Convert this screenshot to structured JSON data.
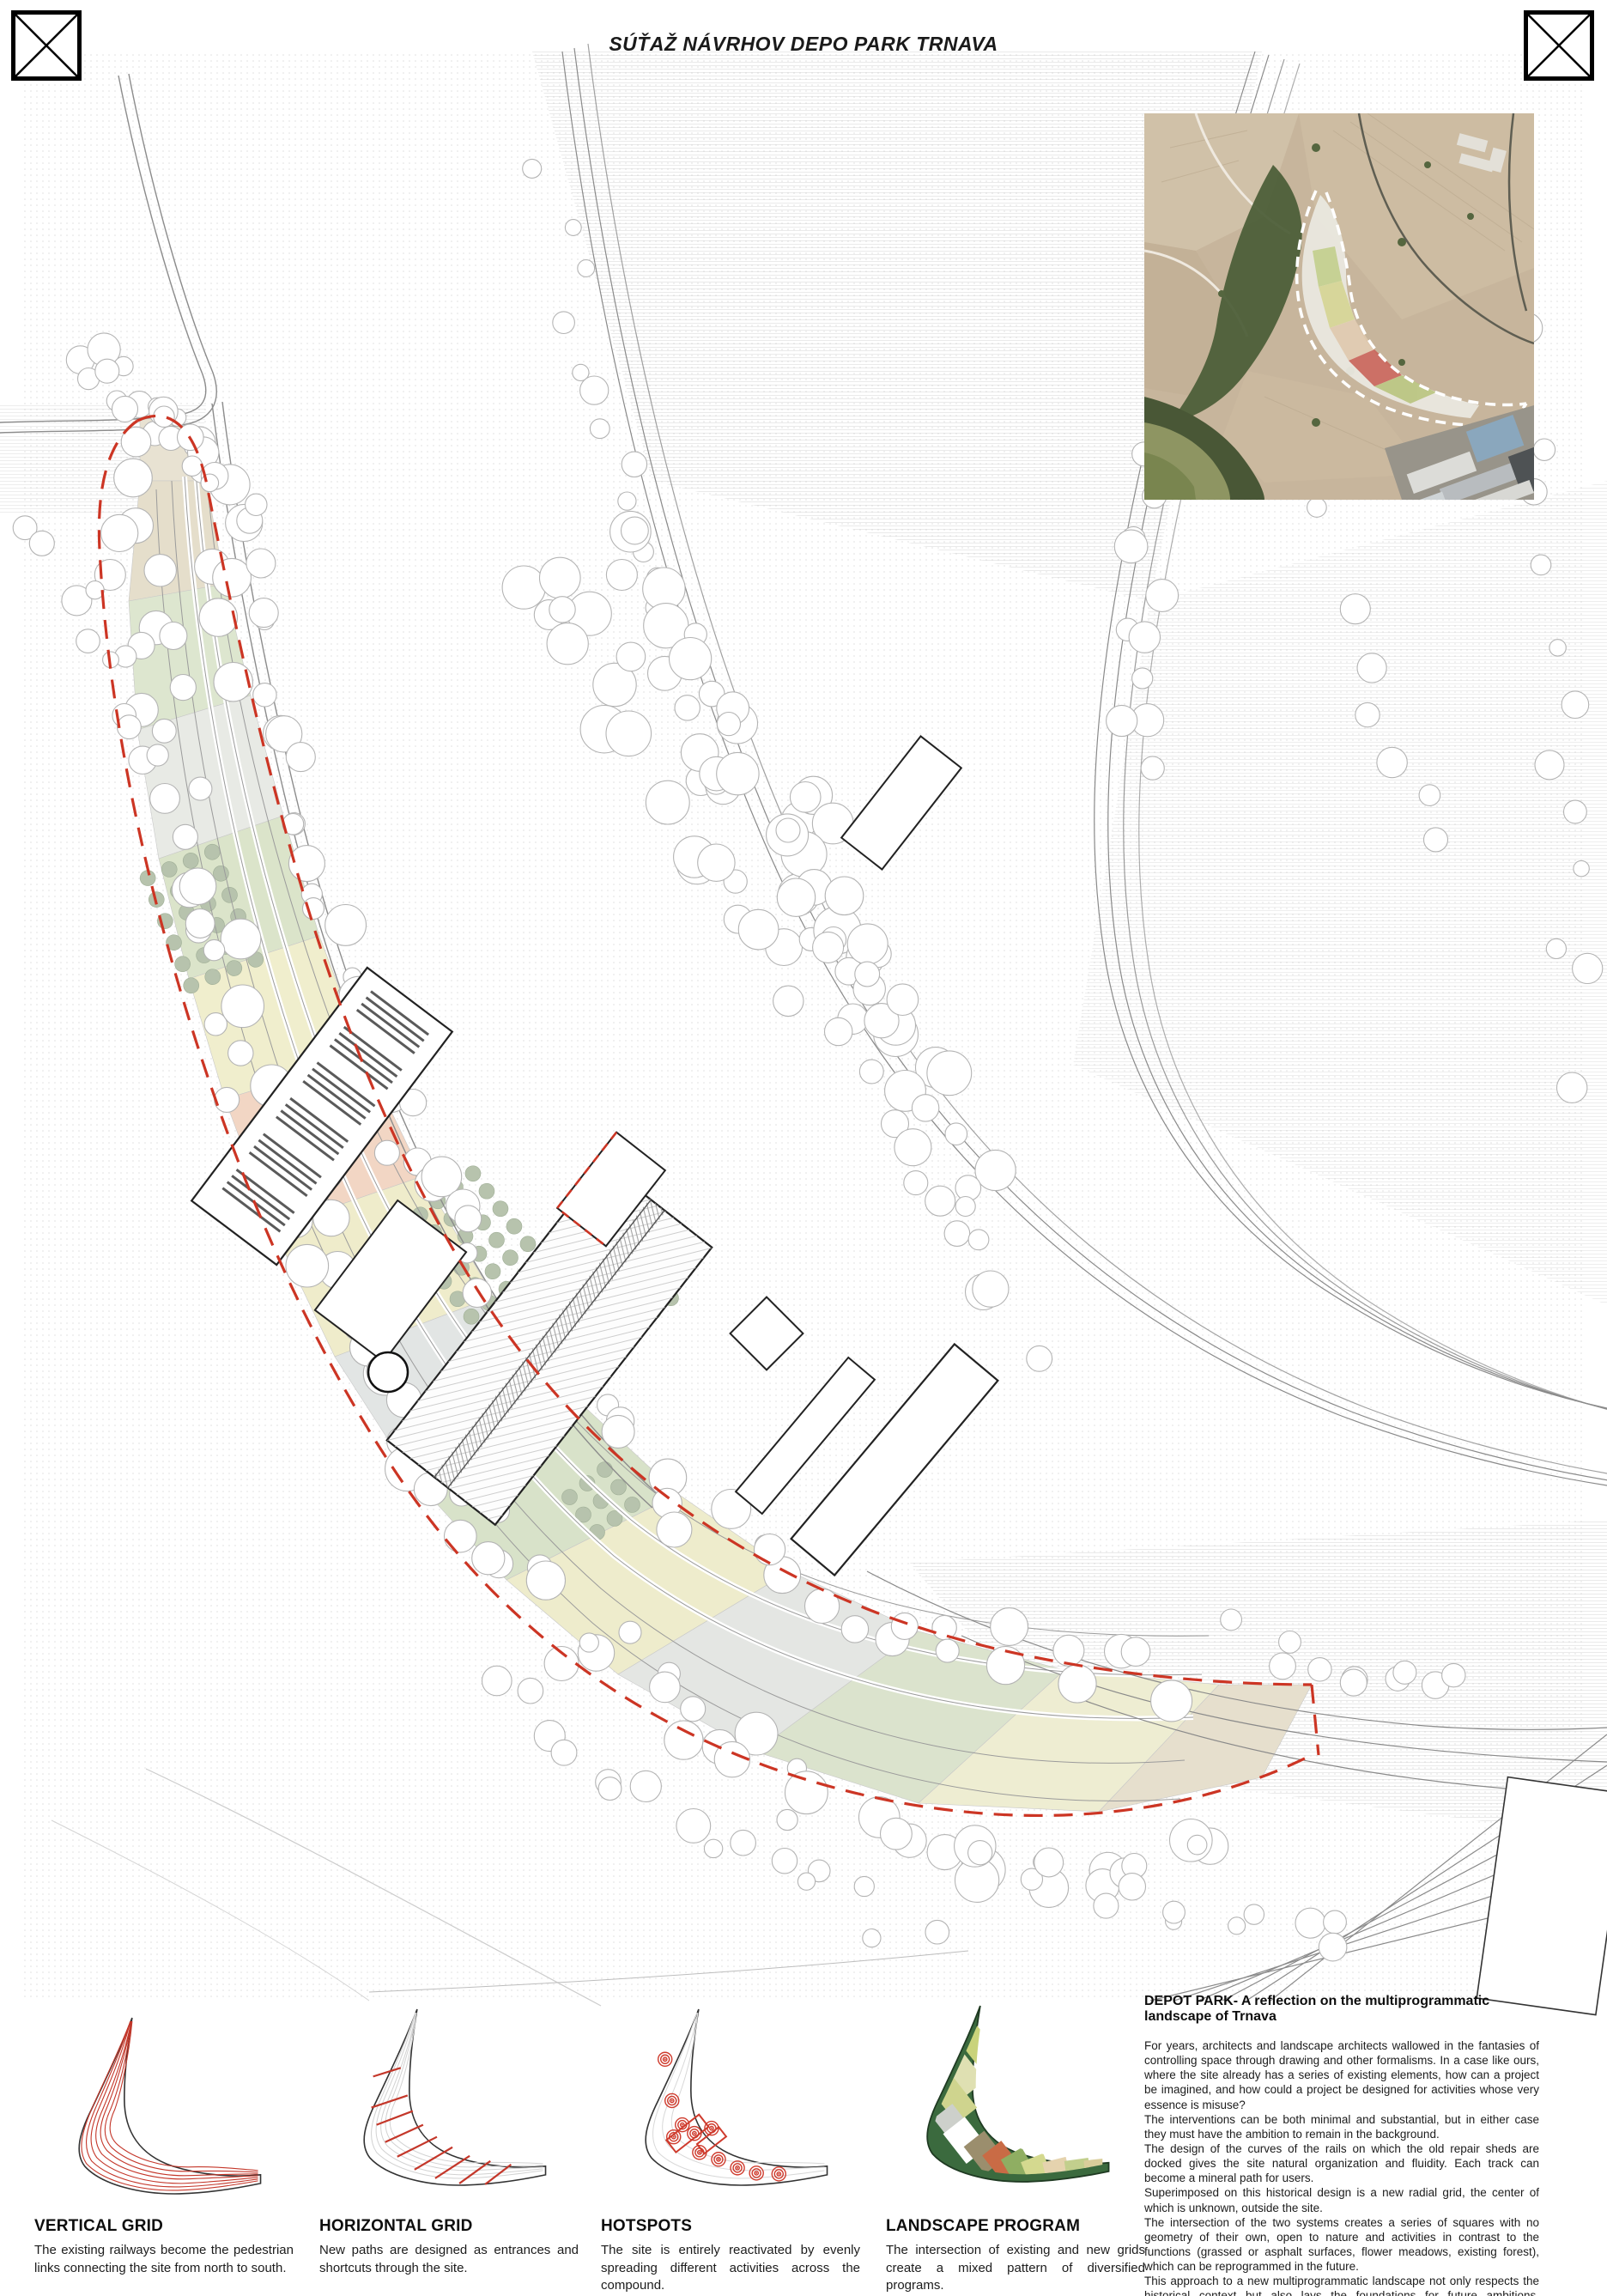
{
  "page": {
    "title": "SÚŤAŽ NÁVRHOV DEPO PARK TRNAVA"
  },
  "icons": {
    "top_left": "crossed-box-icon",
    "top_right": "crossed-box-icon"
  },
  "colors": {
    "accent_red": "#cc3524",
    "diagram_red": "#c4372a",
    "tree_outline": "#b4b4b4",
    "parcel_beige": "#e5decb",
    "parcel_green": "#dbe4ca",
    "parcel_yellow": "#f0eecd",
    "parcel_pink": "#f2d6c4",
    "parcel_gray": "#e4e6e3",
    "orchard_dot": "#b7c3ad",
    "landscape_dark_green": "#3b6a3e",
    "aerial_field_tan": "#c7b59c",
    "aerial_forest_green": "#4d5f39",
    "aerial_water_green": "#8e9562"
  },
  "diagrams": [
    {
      "title": "VERTICAL GRID",
      "caption": "The existing railways become the pedestrian links connecting the site from north to south."
    },
    {
      "title": "HORIZONTAL GRID",
      "caption": "New paths are designed as entrances and shortcuts through the site."
    },
    {
      "title": "HOTSPOTS",
      "caption": "The site is entirely reactivated by evenly spreading different activities across the compound."
    },
    {
      "title": "LANDSCAPE PROGRAM",
      "caption": "The intersection of existing and new grids create a mixed pattern of diversified programs."
    }
  ],
  "description": {
    "heading": "DEPOT PARK- A reflection on the multiprogrammatic landscape of Trnava",
    "paragraphs": [
      "For years, architects and landscape architects wallowed in the fantasies of controlling space through drawing and other formalisms. In a case like ours, where the site already has a series of existing elements, how can a project be imagined, and how could a project be designed for activities whose very essence is misuse?",
      "The interventions can be both minimal and substantial, but in either case they must have the ambition to remain in the background.",
      "The design of the curves of the rails on which the old repair sheds are docked gives the site natural organization and fluidity. Each track can become a mineral path for users.",
      "Superimposed on this historical design is a new radial grid, the center of which is unknown, outside the site.",
      "The intersection of the two systems creates a series of squares with no geometry of their own, open to nature and activities in contrast to the functions (grassed or asphalt surfaces, flower meadows, existing forest), which can be reprogrammed in the future.",
      "This approach to a new multiprogrammatic landscape not only respects the historical context but also lays the foundations for future ambitions, showcasing a dynamic and responsive vision for the site."
    ]
  }
}
